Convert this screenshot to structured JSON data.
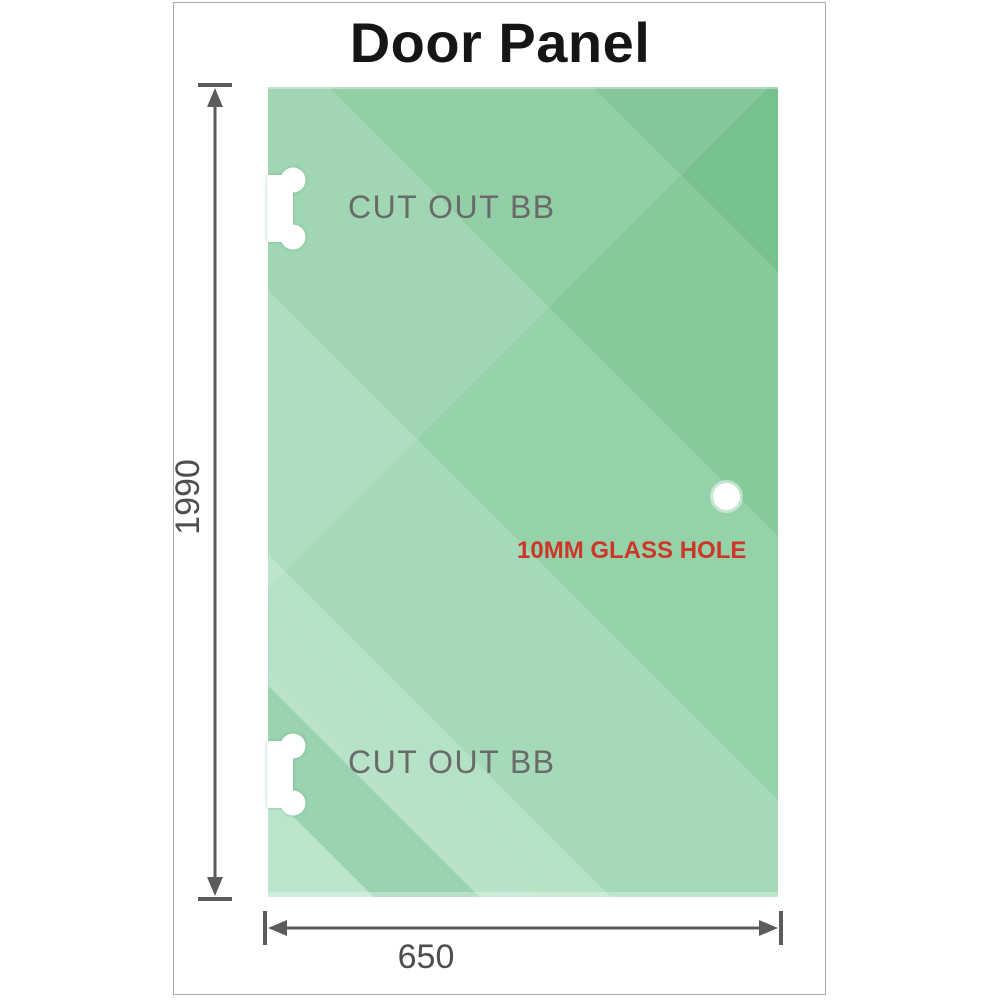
{
  "title": "Door Panel",
  "diagram": {
    "panel": {
      "description": "glass door panel",
      "glass_color_dark": "#77c18f",
      "glass_color_light": "#bce6cc",
      "cutouts": [
        {
          "label": "CUT OUT BB",
          "position": "top-left-edge"
        },
        {
          "label": "CUT OUT BB",
          "position": "bottom-left-edge"
        }
      ],
      "hole": {
        "label": "10MM GLASS HOLE",
        "label_color": "#cd372a",
        "position": "middle-right"
      }
    },
    "dimensions": {
      "height": {
        "value": "1990",
        "orientation": "vertical"
      },
      "width": {
        "value": "650",
        "orientation": "horizontal"
      }
    },
    "dimension_color": "#5b5b5b",
    "label_color": "#6a6a6a",
    "card_border_color": "#ababab"
  }
}
